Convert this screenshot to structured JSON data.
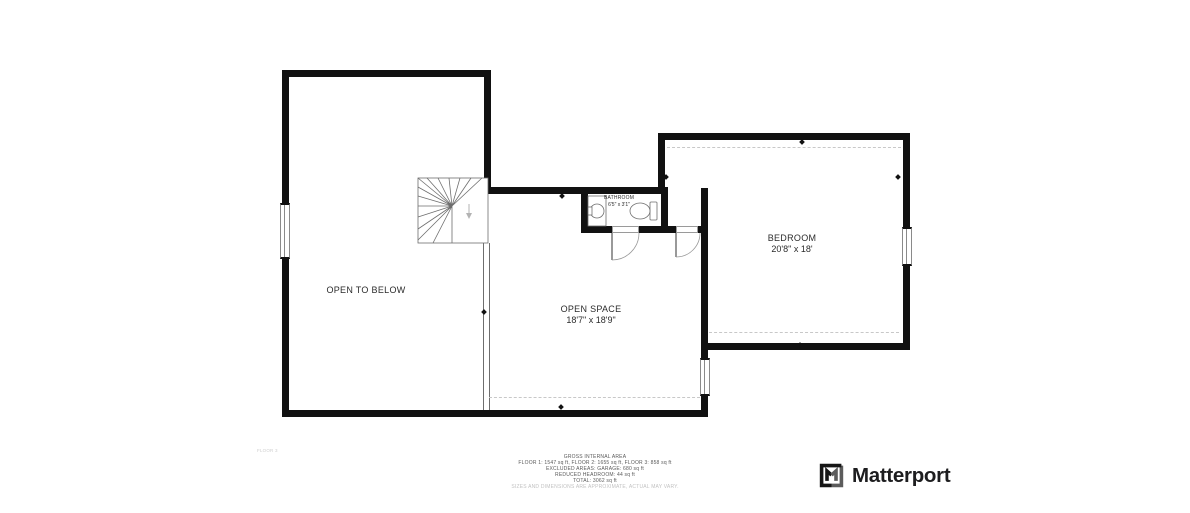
{
  "rooms": [
    {
      "id": "open-to-below",
      "name": "OPEN TO BELOW",
      "dimensions": ""
    },
    {
      "id": "open-space",
      "name": "OPEN SPACE",
      "dimensions": "18'7\" x 18'9\""
    },
    {
      "id": "bedroom",
      "name": "BEDROOM",
      "dimensions": "20'8\" x 18'"
    },
    {
      "id": "bathroom",
      "name": "BATHROOM",
      "dimensions": "6'5\" x 3'1\""
    }
  ],
  "floor_label": "FLOOR 3",
  "footer": {
    "title": "GROSS INTERNAL AREA",
    "line1": "FLOOR 1: 1547 sq ft, FLOOR 2: 1655 sq ft, FLOOR 3: 858 sq ft",
    "line2": "EXCLUDED AREAS: GARAGE: 680 sq ft",
    "line3": "REDUCED HEADROOM: 44 sq ft",
    "line4": "TOTAL: 3062 sq ft",
    "disclaimer": "SIZES AND DIMENSIONS ARE APPROXIMATE, ACTUAL MAY VARY."
  },
  "brand": {
    "name": "Matterport"
  },
  "icons": {
    "staircase": "staircase",
    "toilet": "toilet-icon",
    "sink": "sink-icon",
    "logo": "matterport-logo-icon"
  },
  "colors": {
    "wall": "#111111",
    "thin_line": "#6e6e6e",
    "dashed_line": "#c8c8c8",
    "label_text": "#2b2b2b",
    "footer_text": "#5a5a5a",
    "disclaimer_text": "#c2c2c2",
    "floor_label_text": "#cfcfcf",
    "brand_text": "#1d1d1f"
  }
}
